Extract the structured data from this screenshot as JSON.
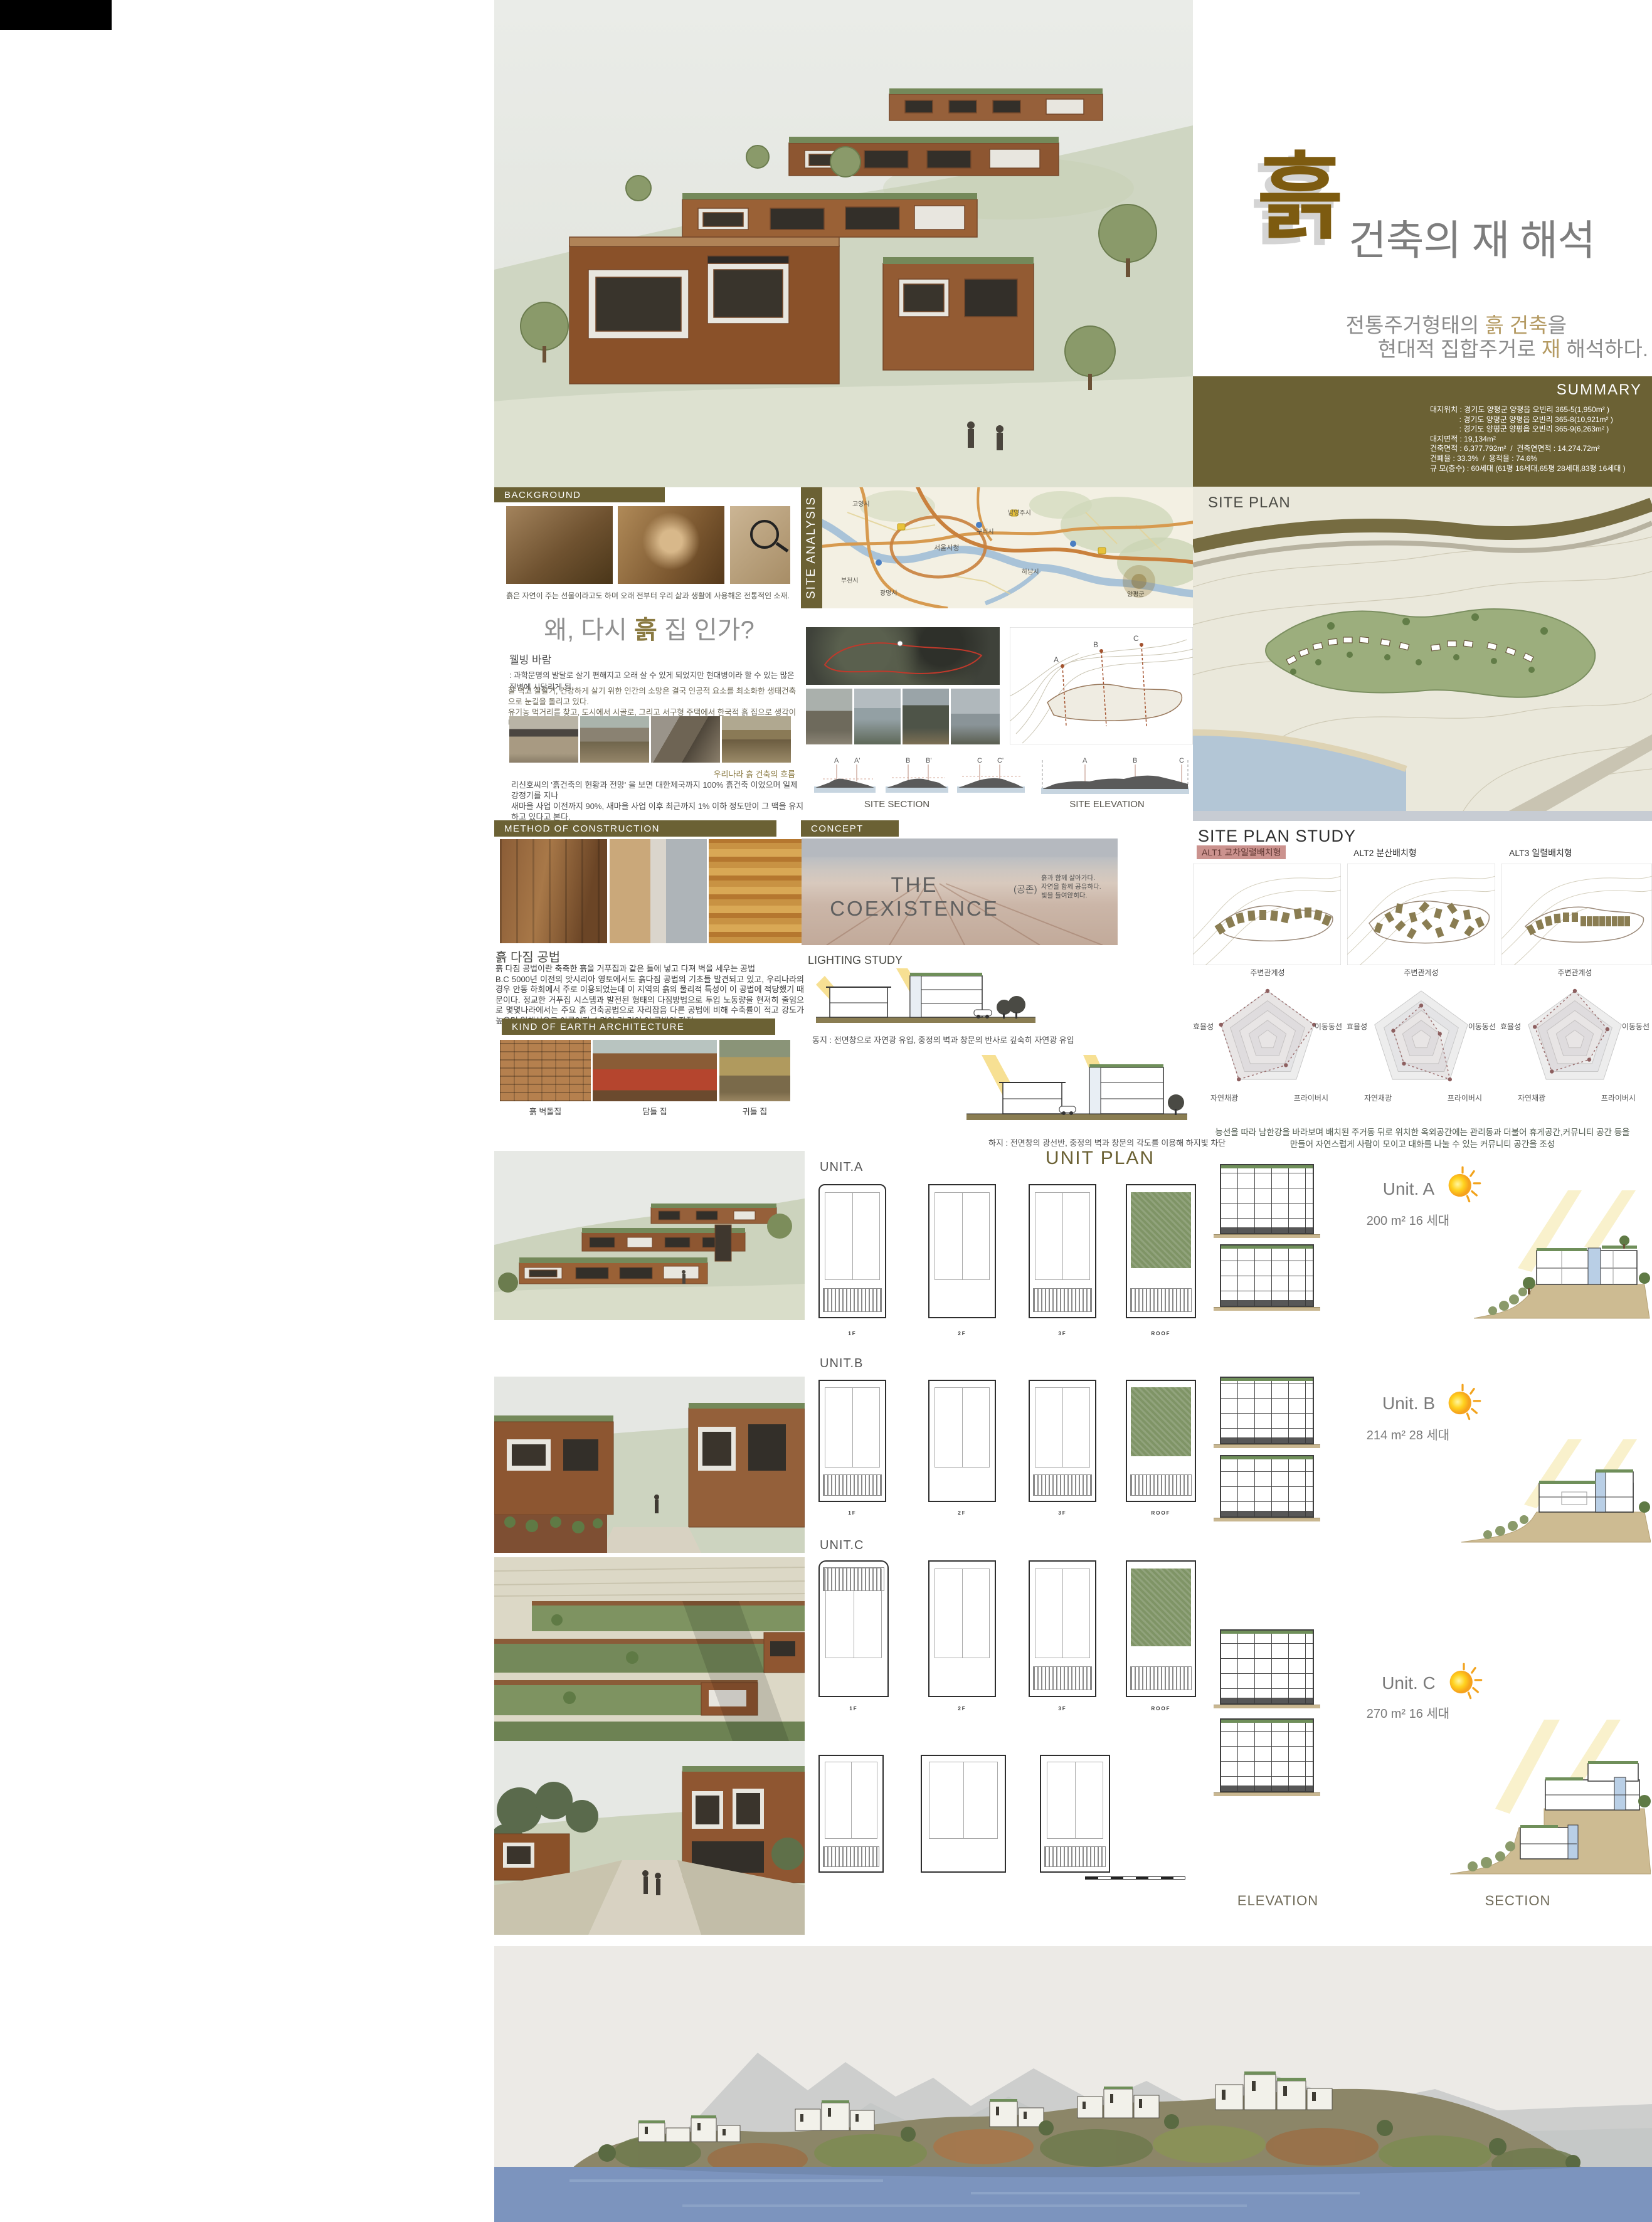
{
  "title": {
    "logo": "흙",
    "main": "건축의 재 해석",
    "sub1_pre": "전통주거형태의 ",
    "sub1_accent": "흙 건축",
    "sub1_post": "을",
    "sub2_pre": "현대적 집합주거로 ",
    "sub2_accent": "재",
    "sub2_post": " 해석하다.",
    "accent_color": "#b49a62",
    "logo_color": "#7d5b10"
  },
  "summary": {
    "header": "SUMMARY",
    "lines": [
      "대지위치 : 경기도 양평군 양평읍 오빈리 365-5(1,950m² )",
      "              : 경기도 양평군 양평읍 오빈리 365-8(10,921m² )",
      "              : 경기도 양평군 양평읍 오빈리 365-9(6,263m² )",
      "대지면적 : 19,134m²",
      "건축면적 : 6,377.792m²  /  건축연면적 : 14,274.72m²",
      "건폐율 : 33.3%  /  용적율 : 74.6%",
      "규 모(층수) : 60세대 (61평 16세대,65평 28세대,83평 16세대 )"
    ],
    "panel_color": "#6b6134"
  },
  "site_plan": {
    "label": "SITE PLAN"
  },
  "background": {
    "header": "BACKGROUND",
    "caption": "흙은 자연이 주는 선물이라고도 하며  오래 전부터 우리 삶과 생활에 사용해온 전통적인 소재."
  },
  "site_analysis": {
    "vertical_label": "SITE ANALYSIS",
    "map_labels": [
      "고양시",
      "서울시청",
      "부천시",
      "광명시",
      "구리시",
      "남양주시",
      "하남시",
      "양평군"
    ],
    "contour_marks": [
      "A",
      "B",
      "C"
    ],
    "section_marks": [
      "A",
      "A'",
      "B",
      "B'",
      "C",
      "C'"
    ],
    "elevation_marks": [
      "A",
      "B",
      "C"
    ],
    "site_section_label": "SITE SECTION",
    "site_elevation_label": "SITE ELEVATION"
  },
  "why": {
    "title_pre": "왜, 다시 ",
    "title_accent": "흙",
    "title_post": " 집 인가?",
    "subhead": "웰빙 바람",
    "p1": ": 과학문명의 발달로 살기 편해지고 오래 살 수 있게 되었지만 현대병이라 할 수 있는 많은  질병에 시달리게 됨.",
    "p2": "잘 먹고 잘살기, 건강하게 살기 위한 인간의 소망은 결국 인공적 요소를 최소화한 생태건축으로 눈길을 돌리고 있다.\n유기농 먹거리를 찾고, 도시에서 시골로, 그리고 서구형 주택에서 한국적 흙 집으로 생각이 바뀌고 있는 것이다.",
    "flow_caption": "우리나라 흙 건축의 흐름",
    "p3": "리신호씨의  '흙건축의 현황과 전망'  을 보면 대한제국까지 100% 흙건축 이었으며 일제 강정기를 지나\n새마을 사업 이전까지 90%, 새마을 사업 이후 최근까지 1% 이하 정도만이 그 맥을 유지하고 있다고 본다."
  },
  "method": {
    "header": "METHOD OF CONSTRUCTION",
    "subhead": "흙 다짐 공법",
    "body": "흙 다짐 공법이란 축축한 흙을 거푸집과 같은 틀에 넣고 다져 벽을 세우는 공법\nB.C 5000년 이전의 앗시리아 영토에서도 흙다짐 공법의 기초들 발견되고 있고, 우리나라의 경우 안동 하회에서 주로 이용되었는데 이 지역의 흙의 물리적 특성이 이 공법에 적당했기 때문이다. 정교한 거푸집 시스템과 발전된 형태의 다짐방법으로 투입 노동량을 현저히 줄임으로 몇몇나라에서는 주요 흙 건축공법으로 자리잡음 다른 공법에 비해 수축률이 적고 강도가 높으며 일체식으로 이루어져 수명이 긴 것이 이 공법의 장점."
  },
  "kind": {
    "header": "KIND OF EARTH ARCHITECTURE",
    "labels": [
      "흙 벽돌집",
      "담틀 집",
      "귀틀 집"
    ]
  },
  "concept": {
    "header": "CONCEPT",
    "main": "THE COEXISTENCE",
    "paren": "(공존)",
    "side": "흙과 함께 살아가다.\n자연을 함께 공유하다.\n빛을 들여앉히다.",
    "lighting_label": "LIGHTING STUDY",
    "winter_caption": "동지 : 전면창으로 자연광 유입, 중정의 벽과 창문의 반사로 깊숙히 자연광 유입",
    "summer_caption": "하지 : 전면창의 광선반, 중정의 벽과 창문의 각도를 이용해 하지빛 차단"
  },
  "sps": {
    "title": "SITE PLAN STUDY",
    "alts": [
      "ALT1  교차일렬배치형",
      "ALT2  분산배치형",
      "ALT3  일렬배치형"
    ],
    "alt1_highlight": "#cb928e",
    "radar_axes": [
      "주변관계성",
      "이동동선",
      "프라이버시",
      "자연채광",
      "효율성"
    ],
    "charts": [
      {
        "name": "ALT1",
        "values": [
          5,
          5,
          3.2,
          5,
          5
        ]
      },
      {
        "name": "ALT2",
        "values": [
          3.5,
          2,
          5,
          3,
          3
        ]
      },
      {
        "name": "ALT3",
        "values": [
          5,
          3.5,
          2.5,
          4,
          4.3
        ]
      }
    ],
    "caption": "능선을 따라 남한강을 바라보며 배치된 주거동 뒤로 위치한 옥외공간에는 관리동과 더불어 휴게공간,커뮤니티 공간 등을\n만들어  자연스럽게 사람이 모이고 대화를 나눌 수 있는 커뮤니티 공간을 조성"
  },
  "unit_plan": {
    "title": "UNIT PLAN",
    "floors": [
      "1F",
      "2F",
      "3F",
      "ROOF"
    ],
    "units": [
      {
        "label": "UNIT.A",
        "name": "Unit. A",
        "size": "200 m²  16 세대"
      },
      {
        "label": "UNIT.B",
        "name": "Unit. B",
        "size": "214 m²  28 세대"
      },
      {
        "label": "UNIT.C",
        "name": "Unit. C",
        "size": "270 m²  16 세대"
      }
    ],
    "elevation_label": "ELEVATION",
    "section_label": "SECTION"
  }
}
